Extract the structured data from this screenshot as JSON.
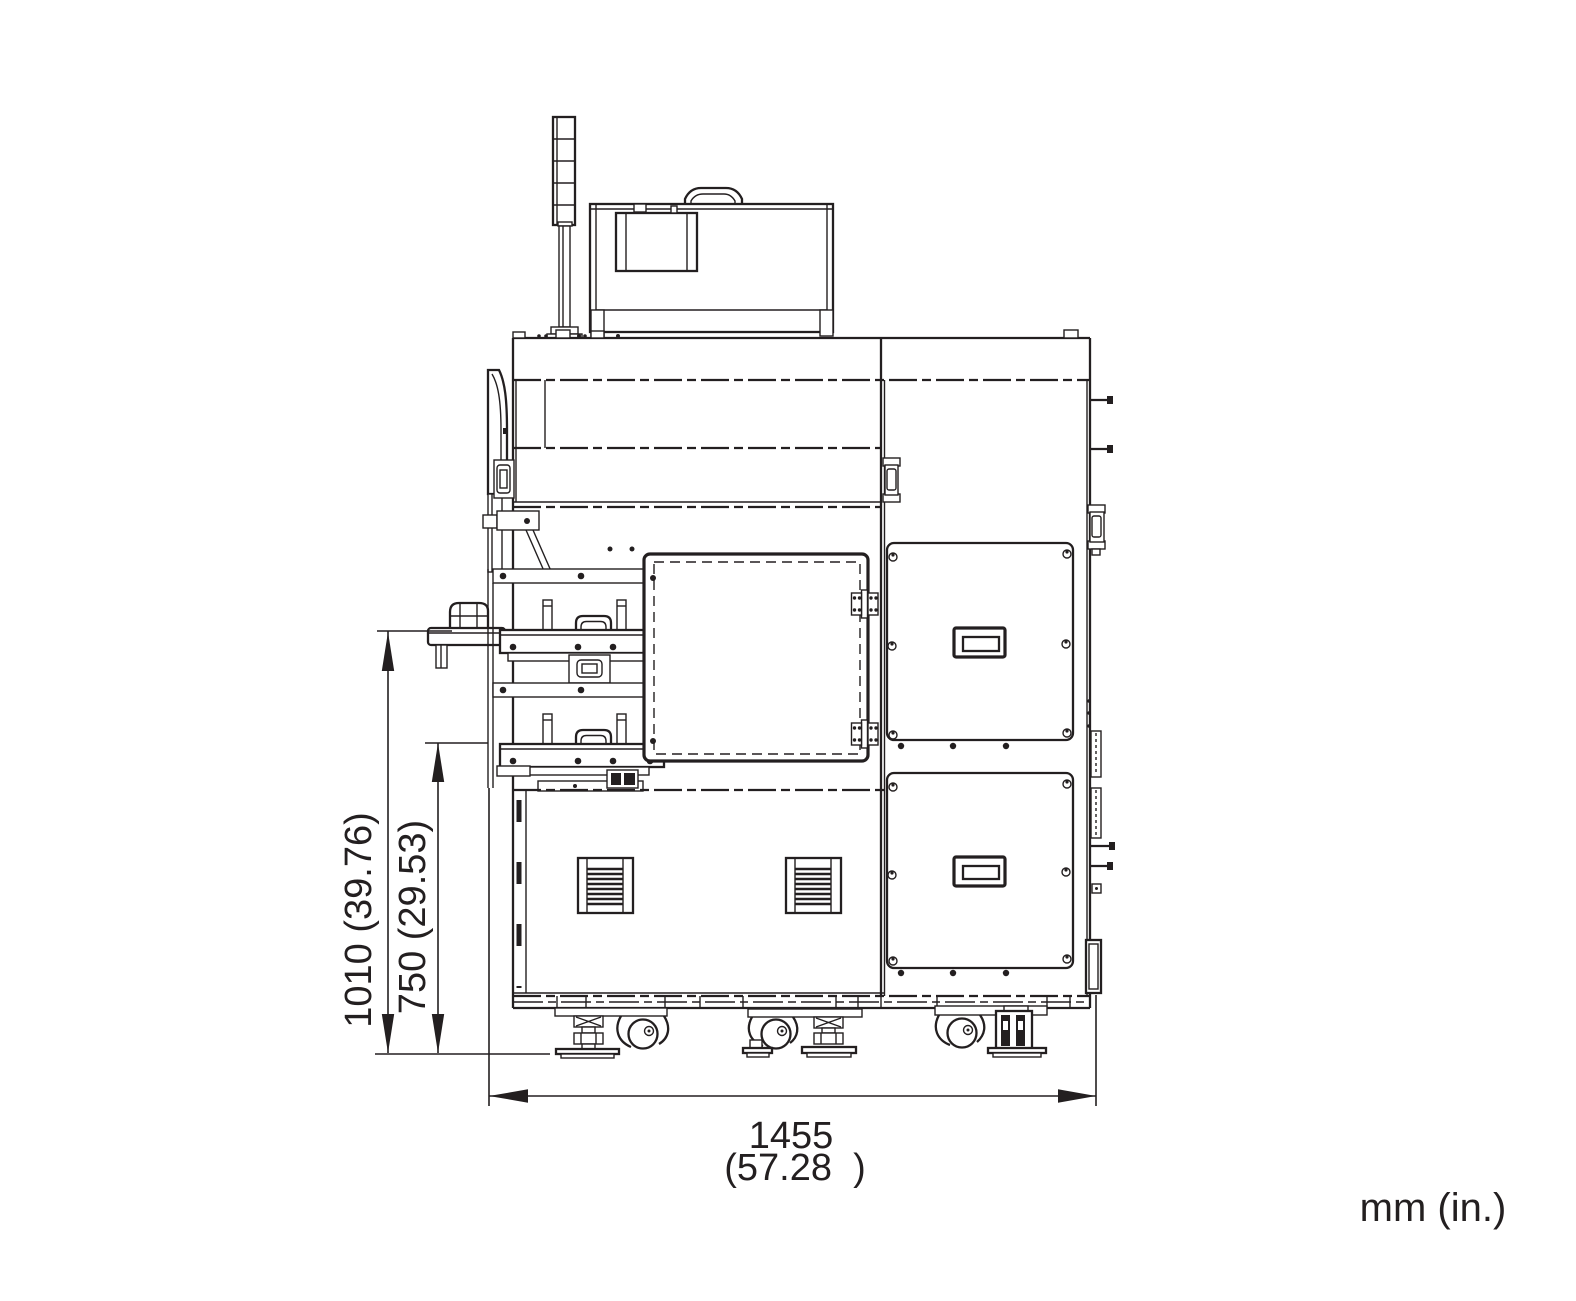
{
  "dimensions": {
    "overall_height": "1010 (39.76)",
    "tray_height": "750 (29.53)",
    "overall_width_mm": "1455",
    "overall_width_in": "(57.28  )"
  },
  "units": {
    "label": "mm (in.)"
  },
  "colors": {
    "line": "#231f20",
    "background": "#ffffff"
  }
}
